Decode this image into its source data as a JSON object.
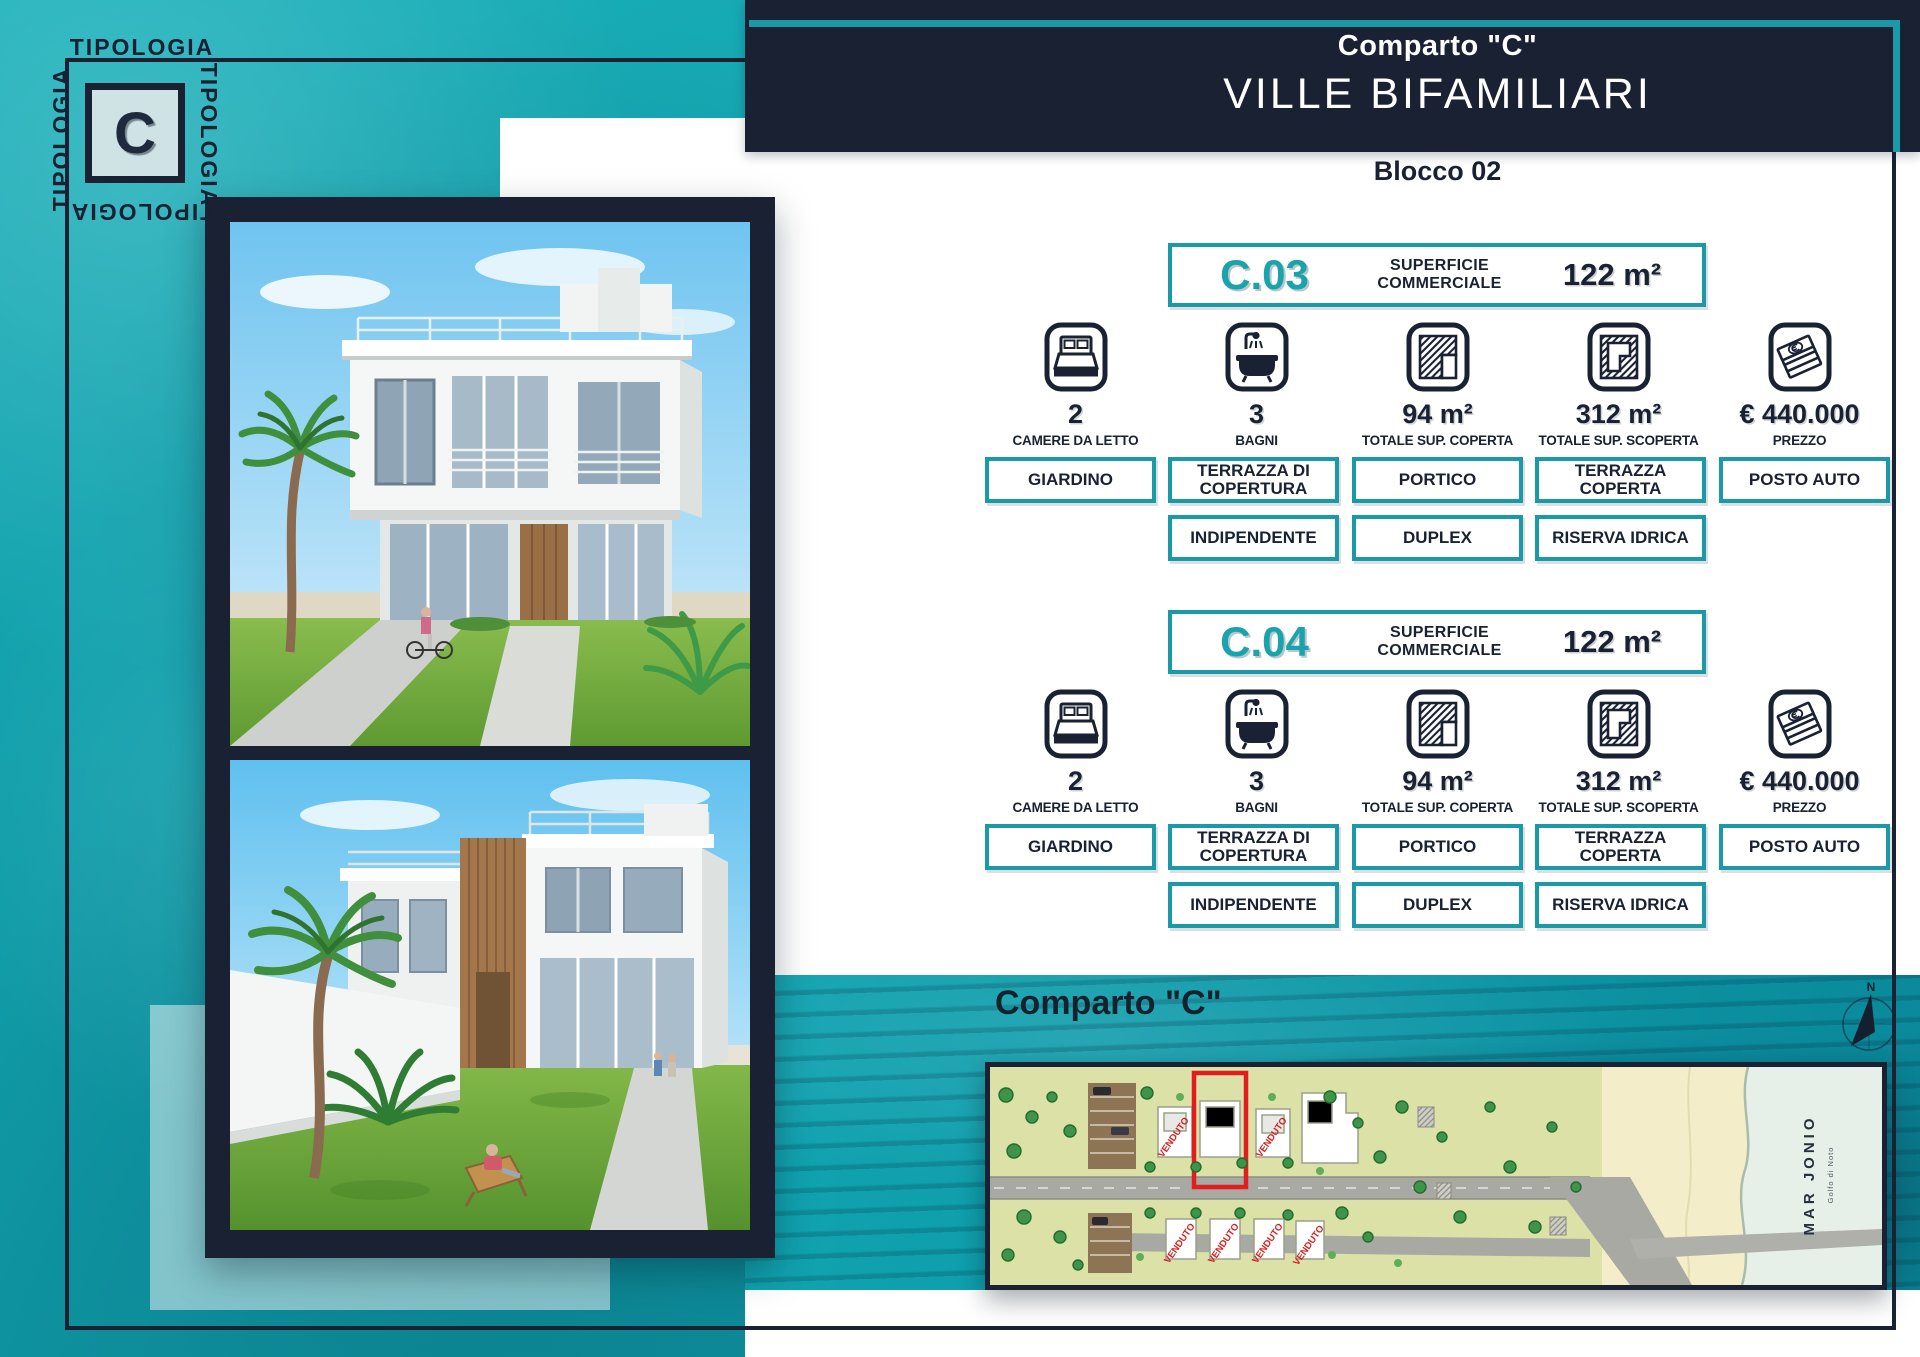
{
  "logo": {
    "word": "TIPOLOGIA",
    "letter": "C"
  },
  "header": {
    "subtitle": "Comparto \"C\"",
    "title": "VILLE BIFAMILIARI"
  },
  "block_label": "Blocco 02",
  "units": [
    {
      "code": "C.03",
      "area_label_line1": "SUPERFICIE",
      "area_label_line2": "COMMERCIALE",
      "area_value": "122 m²",
      "stats": [
        {
          "icon": "bed-icon",
          "value": "2",
          "label": "CAMERE DA LETTO"
        },
        {
          "icon": "bath-icon",
          "value": "3",
          "label": "BAGNI"
        },
        {
          "icon": "covered-surface-icon",
          "value": "94 m²",
          "label": "TOTALE SUP. COPERTA"
        },
        {
          "icon": "uncovered-surface-icon",
          "value": "312 m²",
          "label": "TOTALE SUP. SCOPERTA"
        },
        {
          "icon": "price-icon",
          "value": "€ 440.000",
          "label": "PREZZO"
        }
      ],
      "features_row1": [
        "GIARDINO",
        "TERRAZZA DI COPERTURA",
        "PORTICO",
        "TERRAZZA COPERTA",
        "POSTO AUTO"
      ],
      "features_row2": [
        "INDIPENDENTE",
        "DUPLEX",
        "RISERVA IDRICA"
      ]
    },
    {
      "code": "C.04",
      "area_label_line1": "SUPERFICIE",
      "area_label_line2": "COMMERCIALE",
      "area_value": "122 m²",
      "stats": [
        {
          "icon": "bed-icon",
          "value": "2",
          "label": "CAMERE DA LETTO"
        },
        {
          "icon": "bath-icon",
          "value": "3",
          "label": "BAGNI"
        },
        {
          "icon": "covered-surface-icon",
          "value": "94 m²",
          "label": "TOTALE SUP. COPERTA"
        },
        {
          "icon": "uncovered-surface-icon",
          "value": "312 m²",
          "label": "TOTALE SUP. SCOPERTA"
        },
        {
          "icon": "price-icon",
          "value": "€ 440.000",
          "label": "PREZZO"
        }
      ],
      "features_row1": [
        "GIARDINO",
        "TERRAZZA DI COPERTURA",
        "PORTICO",
        "TERRAZZA COPERTA",
        "POSTO AUTO"
      ],
      "features_row2": [
        "INDIPENDENTE",
        "DUPLEX",
        "RISERVA IDRICA"
      ]
    }
  ],
  "siteplan": {
    "heading": "Comparto \"C\"",
    "sold_label": "VENDUTO",
    "sea_label": "MAR JONIO",
    "sea_sublabel": "Golfo di Noto",
    "compass_label": "N"
  },
  "colors": {
    "teal_background": "#11a0ac",
    "navy": "#1a2133",
    "teal_accent": "#1a9aa6",
    "unit_code_teal": "#1ba3ad",
    "sold_red": "#d41f1f"
  }
}
